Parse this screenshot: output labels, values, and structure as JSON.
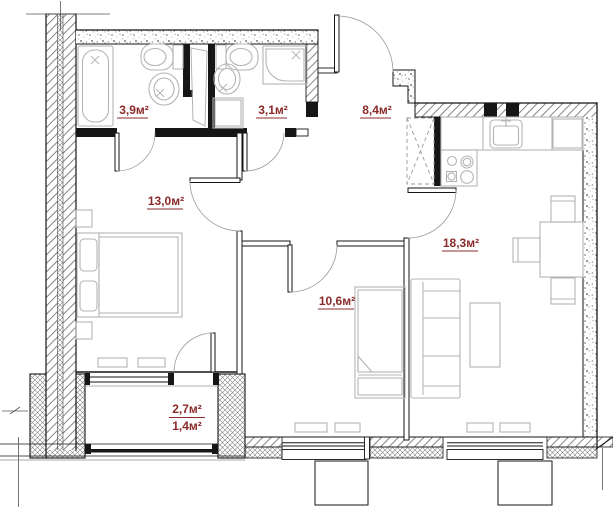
{
  "plan": {
    "type": "apartment-floor-plan",
    "colors": {
      "area_label": "#8b2a2a",
      "wall": "#161616",
      "furniture_outline": "#b4b4b4",
      "hatch_line": "#777777"
    },
    "rooms": {
      "bathroom_large": {
        "area": "3,9м²"
      },
      "bathroom_small": {
        "area": "3,1м²"
      },
      "hallway": {
        "area": "8,4м²"
      },
      "bedroom": {
        "area": "13,0м²"
      },
      "kitchen_living": {
        "area": "18,3м²"
      },
      "room_second": {
        "area": "10,6м²"
      },
      "balcony": {
        "area_total": "2,7м²",
        "area_reduced": "1,4м²"
      }
    },
    "fixtures": [
      "bathtub",
      "toilet",
      "wash-basin",
      "shower-cabin",
      "washing-machine",
      "ventilation-shaft",
      "double-bed",
      "nightstand",
      "single-bed",
      "sofa",
      "coffee-table",
      "dining-table",
      "chair",
      "kitchen-counter",
      "kitchen-sink",
      "cooktop",
      "refrigerator-niche",
      "radiator",
      "window",
      "balcony-glazing",
      "entrance-door",
      "interior-door"
    ]
  }
}
